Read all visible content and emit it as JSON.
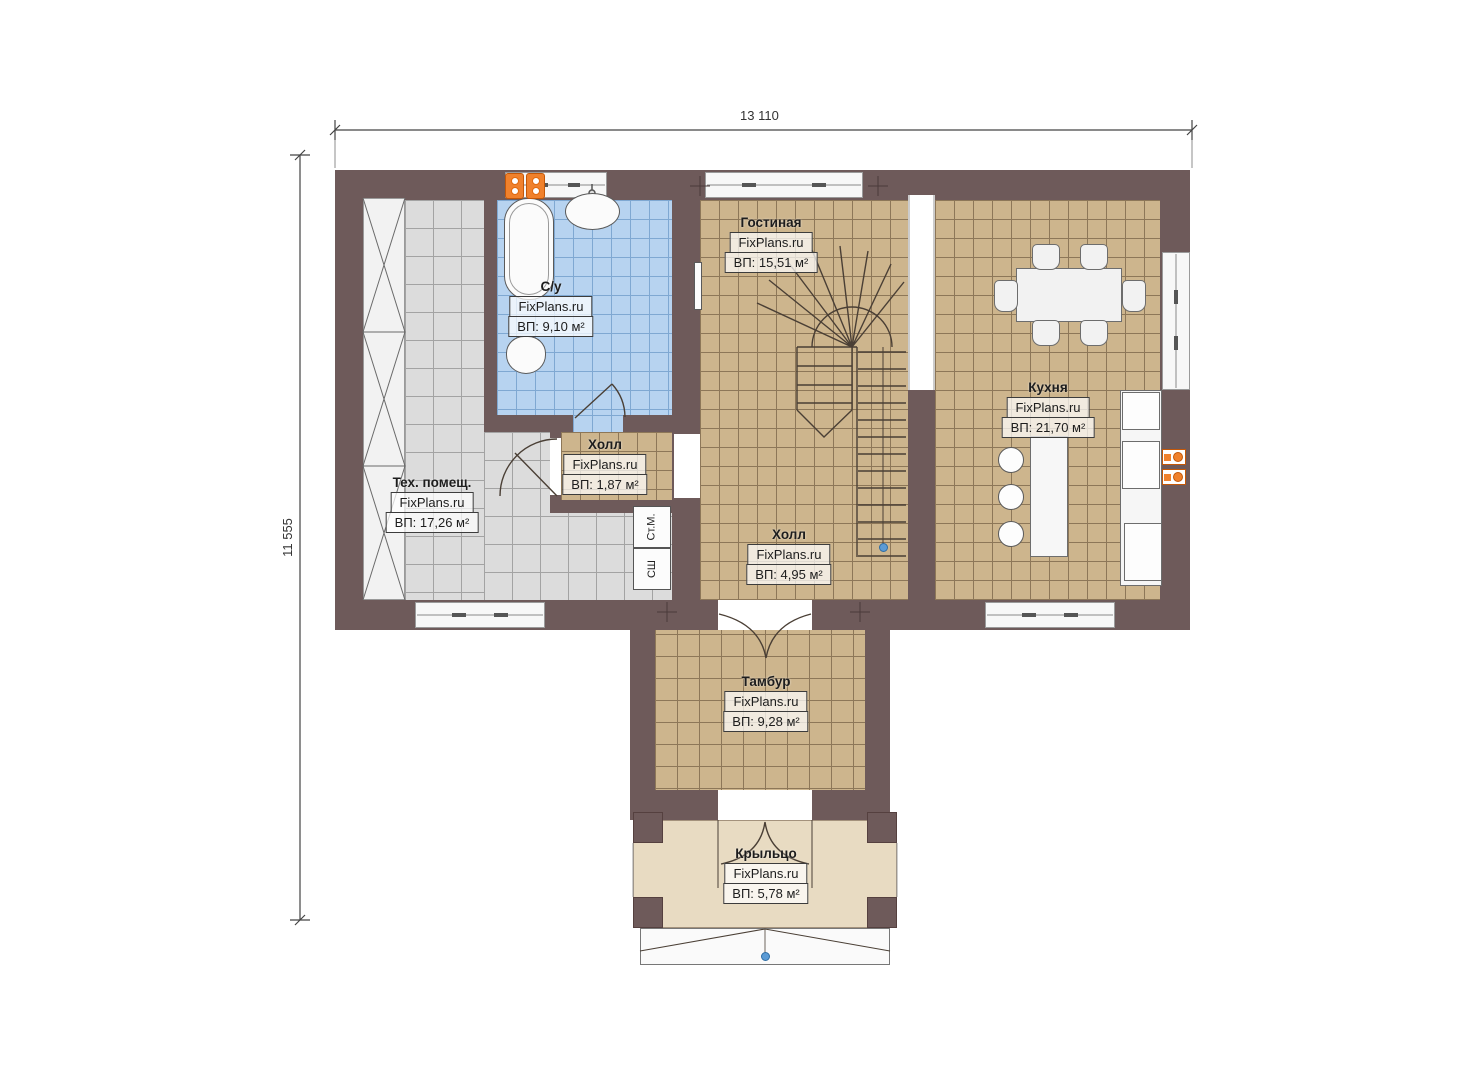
{
  "plan": {
    "watermark": "FixPlans.ru",
    "type": "floor-plan-first-floor"
  },
  "dimensions": {
    "width_label": "13 110",
    "height_label": "11 555"
  },
  "rooms": [
    {
      "name": "Гостиная",
      "brand": "FixPlans.ru",
      "area": "ВП: 15,51 м²"
    },
    {
      "name": "С/у",
      "brand": "FixPlans.ru",
      "area": "ВП: 9,10 м²"
    },
    {
      "name": "Холл",
      "brand": "FixPlans.ru",
      "area": "ВП: 1,87 м²"
    },
    {
      "name": "Тех. помещ.",
      "brand": "FixPlans.ru",
      "area": "ВП: 17,26 м²"
    },
    {
      "name": "Холл",
      "brand": "FixPlans.ru",
      "area": "ВП: 4,95 м²"
    },
    {
      "name": "Кухня",
      "brand": "FixPlans.ru",
      "area": "ВП: 21,70 м²"
    },
    {
      "name": "Тамбур",
      "brand": "FixPlans.ru",
      "area": "ВП: 9,28 м²"
    },
    {
      "name": "Крыльцо",
      "brand": "FixPlans.ru",
      "area": "ВП: 5,78 м²"
    }
  ],
  "appliances": {
    "washing_machine": "Ст.М.",
    "drying_cabinet": "СШ"
  },
  "colors": {
    "wall": "#6e5a5a",
    "floor_tan": "#cdb58d",
    "floor_gray": "#dcdcdc",
    "floor_blue": "#b7d3f0",
    "porch": "#e8dbc2",
    "radiator_orange": "#f0812c",
    "marker_blue": "#5b9bd5"
  }
}
